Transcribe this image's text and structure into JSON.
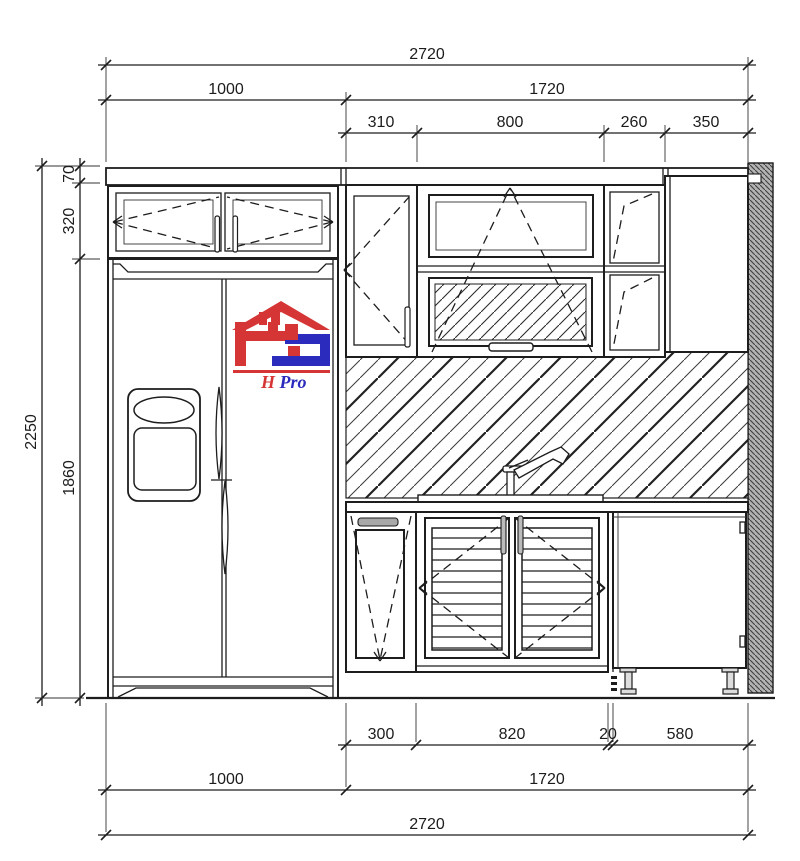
{
  "dimensions": {
    "top_overall": "2720",
    "top_left": "1000",
    "top_right": "1720",
    "top_segments": [
      "310",
      "800",
      "260",
      "350"
    ],
    "left_total": "2250",
    "left_segments": [
      "70",
      "320",
      "1860"
    ],
    "bottom_segments": [
      "300",
      "820",
      "20",
      "580"
    ],
    "bottom_left": "1000",
    "bottom_right": "1720",
    "bottom_overall": "2720"
  },
  "logo": {
    "text_h": "H",
    "text_rest": "Pro",
    "red": "#d63535",
    "blue": "#2b2bbd"
  }
}
